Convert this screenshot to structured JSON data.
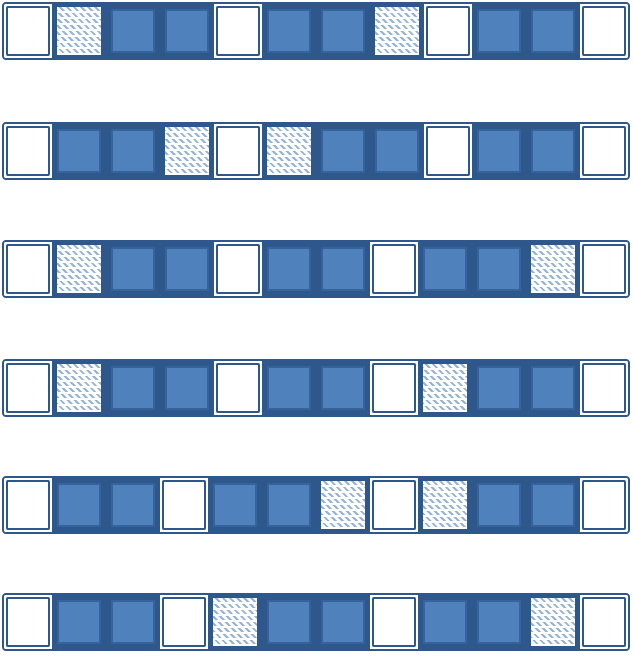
{
  "diagram": {
    "description": "Six horizontal strips, each containing twelve square blocks; each block is either filled solid blue, empty white, or hatched with light blue diagonal strokes",
    "colors": {
      "block_fill": "#4F81BD",
      "block_fill_border": "#36639B",
      "band_dark": "#2E578C",
      "hatch_stroke": "#93B2DA",
      "background": "#FFFFFF"
    },
    "rows": [
      {
        "cells": [
          "empty",
          "hatched",
          "filled",
          "filled",
          "empty",
          "filled",
          "filled",
          "hatched",
          "empty",
          "filled",
          "filled",
          "empty"
        ]
      },
      {
        "cells": [
          "empty",
          "filled",
          "filled",
          "hatched",
          "empty",
          "hatched",
          "filled",
          "filled",
          "empty",
          "filled",
          "filled",
          "empty"
        ]
      },
      {
        "cells": [
          "empty",
          "hatched",
          "filled",
          "filled",
          "empty",
          "filled",
          "filled",
          "empty",
          "filled",
          "filled",
          "hatched",
          "empty"
        ]
      },
      {
        "cells": [
          "empty",
          "hatched",
          "filled",
          "filled",
          "empty",
          "filled",
          "filled",
          "empty",
          "hatched",
          "filled",
          "filled",
          "empty"
        ]
      },
      {
        "cells": [
          "empty",
          "filled",
          "filled",
          "empty",
          "filled",
          "filled",
          "hatched",
          "empty",
          "hatched",
          "filled",
          "filled",
          "empty"
        ]
      },
      {
        "cells": [
          "empty",
          "filled",
          "filled",
          "empty",
          "hatched",
          "filled",
          "filled",
          "empty",
          "filled",
          "filled",
          "hatched",
          "empty"
        ]
      }
    ]
  }
}
